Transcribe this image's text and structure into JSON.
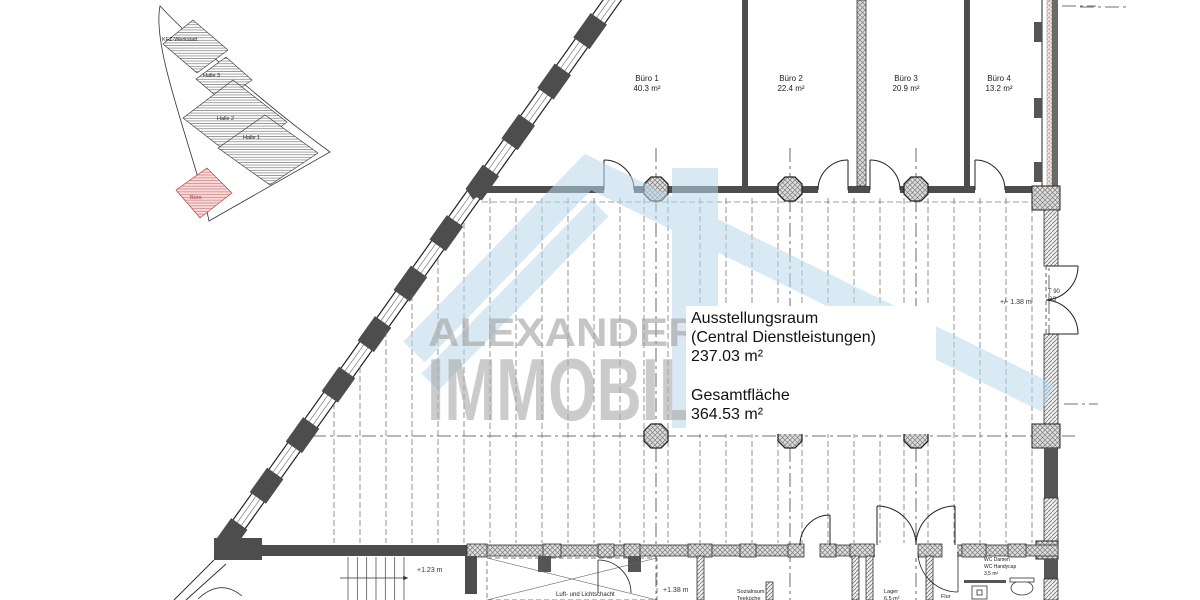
{
  "site_plan": {
    "buildings": [
      {
        "label": "KFZ-Werkstatt"
      },
      {
        "label": "Halle 3"
      },
      {
        "label": "Halle 2"
      },
      {
        "label": "Halle 1"
      },
      {
        "label": "Büro"
      }
    ]
  },
  "offices": [
    {
      "name": "Büro 1",
      "area": "40.3 m²"
    },
    {
      "name": "Büro 2",
      "area": "22.4 m²"
    },
    {
      "name": "Büro 3",
      "area": "20.9 m²"
    },
    {
      "name": "Büro 4",
      "area": "13.2 m²"
    }
  ],
  "showroom": {
    "name": "Ausstellungsraum",
    "subtitle": "(Central Dienstleistungen)",
    "area": "237.03 m²",
    "total_label": "Gesamtfläche",
    "total_area": "364.53 m²"
  },
  "rooms": {
    "shaft": "Luft- und Lichtschacht",
    "sozialraum_line1": "Sozialraum",
    "sozialraum_line2": "Teeküche",
    "lager_line1": "Lager",
    "lager_line2": "6,5 m²",
    "flur": "Flur",
    "wc_line1": "WC Damen",
    "wc_line2": "WC Handycap",
    "wc_line3": "3,5 m²"
  },
  "levels": {
    "stairs": "+1.23 m",
    "shaft": "+1.38 m",
    "right_door": "+/- 1.38 m"
  },
  "door_tags": {
    "t90": "T 90",
    "rs": "RS"
  },
  "watermark": {
    "line1": "ALEXANDER PATZER",
    "line2": "IMMOBILIEN"
  },
  "colors": {
    "wall_dark": "#4d4d4d",
    "roof_blue": "#b9d8ec",
    "watermark_gray": "#a3a3a3",
    "site_red": "#aa3333"
  }
}
